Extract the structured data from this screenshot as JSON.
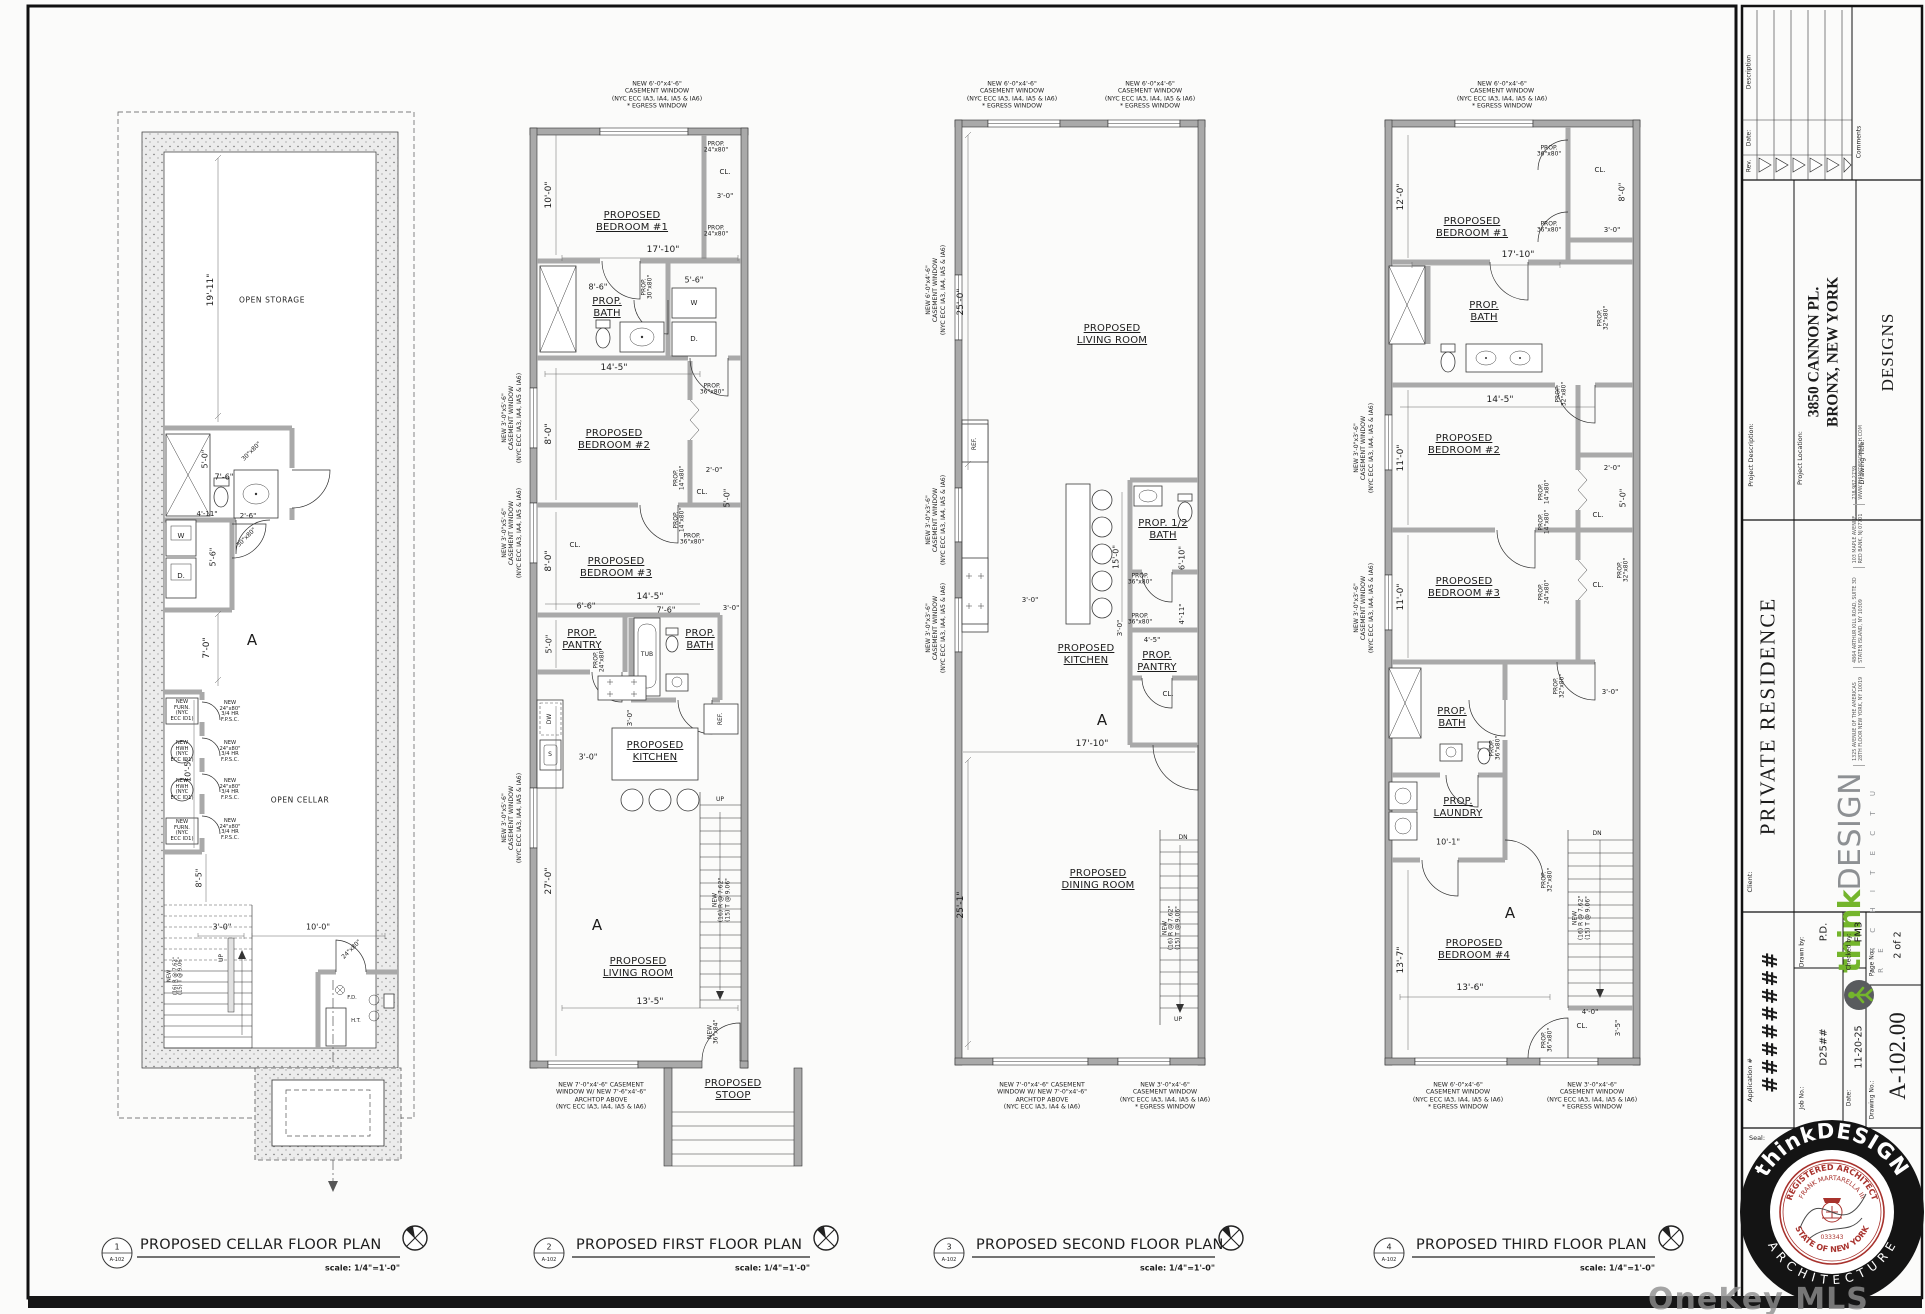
{
  "watermark": "OneKey MLS",
  "colors": {
    "logo_green": "#74b52c",
    "logo_gray": "#8d9093",
    "seal_red": "#a8322d",
    "ink": "#1c1c1c"
  },
  "dims": {
    "d2_0": "2'-0\"",
    "d2_6": "2'-6\"",
    "d3_0": "3'-0\"",
    "d3_5": "3'-5\"",
    "d4_0": "4'-0\"",
    "d4_5": "4'-5\"",
    "d4_11": "4'-11\"",
    "d5_0": "5'-0\"",
    "d5_6": "5'-6\"",
    "d6_6": "6'-6\"",
    "d6_10": "6'-10\"",
    "d7_0": "7'-0\"",
    "d7_6": "7'-6\"",
    "d8_0": "8'-0\"",
    "d8_5": "8'-5\"",
    "d8_6": "8'-6\"",
    "d10_0": "10'-0\"",
    "d10_1": "10'-1\"",
    "d10_5": "10'-5\"",
    "d11_0": "11'-0\"",
    "d12_0": "12'-0\"",
    "d13_5": "13'-5\"",
    "d13_6": "13'-6\"",
    "d13_7": "13'-7\"",
    "d14_5": "14'-5\"",
    "d15_0": "15'-0\"",
    "d17_10": "17'-10\"",
    "d19_11": "19'-11\"",
    "d25_0": "25'-0\"",
    "d25_1": "25'-1\"",
    "d27_0": "27'-0\""
  },
  "rooms": {
    "bed1": "PROPOSED\nBEDROOM #1",
    "bed2": "PROPOSED\nBEDROOM #2",
    "bed3": "PROPOSED\nBEDROOM #3",
    "bed4": "PROPOSED\nBEDROOM #4",
    "living": "PROPOSED\nLIVING ROOM",
    "dining": "PROPOSED\nDINING ROOM",
    "kitchen": "PROPOSED\nKITCHEN",
    "bath": "PROP.\nBATH",
    "half_bath": "PROP. 1/2\nBATH",
    "pantry": "PROP.\nPANTRY",
    "laundry": "PROP.\nLAUNDRY",
    "stoop": "PROPOSED\nSTOOP",
    "open_storage": "OPEN STORAGE",
    "open_cellar": "OPEN CELLAR",
    "cl": "CL.",
    "tub": "TUB",
    "w": "W",
    "d": "D.",
    "dw": "DW",
    "s": "S",
    "ref": "REF.",
    "fd": "F.D.",
    "ht": "H.T.",
    "up": "UP",
    "dn": "DN",
    "section": "A"
  },
  "notes": {
    "n6046e": "NEW 6'-0\"x4'-6\"\nCASEMENT WINDOW\n(NYC ECC IA3, IA4, IA5 & IA6)\n* EGRESS WINDOW",
    "n3046e": "NEW 3'-0\"x4'-6\"\nCASEMENT WINDOW\n(NYC ECC IA3, IA4, IA5 & IA6)\n* EGRESS WINDOW",
    "n3056": "NEW 3'-0\"x5'-6\"\nCASEMENT WINDOW\n(NYC ECC IA3, IA4, IA5 & IA6)",
    "n3036": "NEW 3'-0\"x3'-6\"\nCASEMENT WINDOW\n(NYC ECC IA3, IA4, IA5 & IA6)",
    "n6046": "NEW 6'-0\"x4'-6\"\nCASEMENT WINDOW\n(NYC ECC IA3, IA4, IA5 & IA6)",
    "arch1": "NEW 7'-0\"x4'-6\" CASEMENT\nWINDOW W/ NEW 7'-6\"x4'-6\"\nARCHTOP ABOVE\n(NYC ECC IA3, IA4, IA5 & IA6)",
    "arch2": "NEW 7'-0\"x4'-6\" CASEMENT\nWINDOW W/ NEW 7'-0\"x4'-6\"\nARCHTOP ABOVE\n(NYC ECC IA3, IA4 & IA6)",
    "stair16": "NEW\n(16) R @ 7.62\"\n(15) T @ 9.06\"",
    "fpsc": "NEW\n24\"x80\"\n3/4 HR\nF.P.S.C.",
    "furn": "NEW\nFURN.\n(NYC\nECC ID1)",
    "hwh": "NEW\nHWH\n(NYC\nECC ID1)",
    "d3680": "PROP.\n36\"x80\"",
    "d3280": "PROP.\n32\"x80\"",
    "d3080": "PROP.\n30\"x80\"",
    "d2480": "PROP.\n24\"x80\"",
    "d1480": "PROP.\n14\"x80\"",
    "s3080": "30\"x80\"",
    "s2480": "24\"x80\"",
    "n3684": "NEW\n36\"x84\""
  },
  "plans": {
    "cellar": {
      "num": "1",
      "ref": "A-102",
      "title": "PROPOSED CELLAR FLOOR PLAN"
    },
    "first": {
      "num": "2",
      "ref": "A-102",
      "title": "PROPOSED FIRST FLOOR PLAN"
    },
    "second": {
      "num": "3",
      "ref": "A-102",
      "title": "PROPOSED SECOND FLOOR PLAN"
    },
    "third": {
      "num": "4",
      "ref": "A-102",
      "title": "PROPOSED THIRD FLOOR PLAN"
    },
    "scale_note": "scale: 1/4\"=1'-0\""
  },
  "tb": {
    "rev_label": "Rev.",
    "date_col_label": "Date:",
    "description_label": "Description",
    "comments_label": "Comments",
    "project_description_label": "Project Description:",
    "project_location_label": "Project Location:",
    "project_location_line1": "3850 CANNON PL.",
    "project_location_line2": "BRONX, NEW YORK",
    "drawing_title_label": "Drawing Title:",
    "drawing_title": "DESIGNS",
    "client_label": "Client:",
    "client": "PRIVATE RESIDENCE",
    "logo": {
      "think": "think",
      "design": "DESIGN",
      "architecture": "A R C H I T E C T U R E",
      "addr1a": "1325 AVENUE OF THE AMERICAS",
      "addr1b": "28TH FLOOR NEW YORK, NY 10019",
      "addr2a": "4864 ARTHUR KILL ROAD, SUITE 3D",
      "addr2b": "STATEN ISLAND, NY 10309",
      "addr3a": "103 MAPLE AVENUE",
      "addr3b": "RED BANK, NJ 07701",
      "addr4a": "718.987.2739",
      "addr4b": "WWW.THINKDESIGNARCH.COM"
    },
    "application_label": "Application #",
    "application_value": "########",
    "job_no_label": "Job No.:",
    "job_no": "D25##",
    "drawn_by_label": "Drawn by:",
    "drawn_by": "P.D.",
    "date_label": "Date:",
    "date": "11-20-25",
    "checked_by_label": "Checked by:",
    "checked_by": "FM3",
    "drawing_no_label": "Drawing No.:",
    "drawing_no": "A-102.00",
    "page_no_label": "Page No.:",
    "page_no": "2 of 2",
    "seal_label": "Seal:"
  },
  "seal": {
    "ring_top": "thinkDESIGN",
    "ring_bottom": "A R C H I T E C T U R E",
    "reg1": "REGISTERED ARCHITECT",
    "reg2": "FRANK MARTARELLA III",
    "state": "STATE OF NEW YORK",
    "number": "033343"
  }
}
